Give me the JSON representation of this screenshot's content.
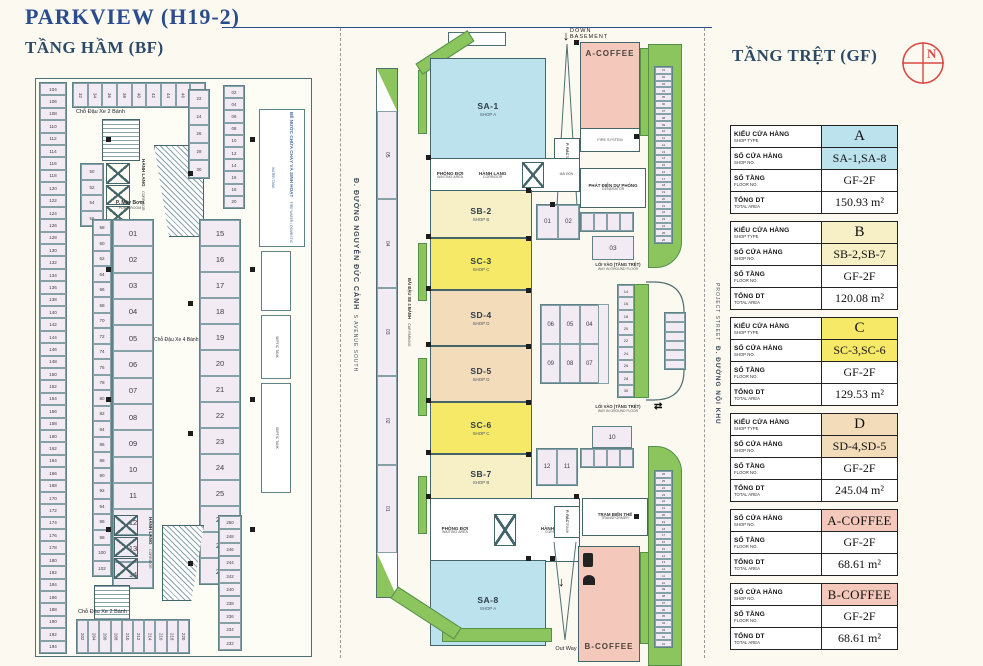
{
  "page": {
    "title": "PARKVIEW (H19-2)",
    "bf_title": "TẦNG HẦM (BF)",
    "gf_title": "TẦNG TRỆT (GF)",
    "compass": "N"
  },
  "colors": {
    "shopA": "#bce2ee",
    "shopB": "#f7f0c6",
    "shopC": "#f6e967",
    "shopD": "#f2dcba",
    "coffee": "#f4c8ba",
    "stall": "#f3ebf3",
    "green": "#8cc45e",
    "accent_red": "#d84a44",
    "title_blue": "#2b4d8e"
  },
  "bf": {
    "bike_top": "Chỗ Đậu Xe 2 Bánh",
    "bike_bottom": "Chỗ Đậu Xe 2 Bánh",
    "car": "Chỗ Đậu Xe 4 Bánh",
    "pump_vn": "P. Máy Bơm",
    "pump_en": "PUMP ROOM",
    "corridor_vn": "HÀNH LANG",
    "corridor_en": "CORRIDOR",
    "tank_vn": "BỂ NƯỚC CHỨA CHÁY VÀ SINH HOẠT",
    "tank_en": "FIRE WATER / DOMESTIC WATER TANK",
    "septic_en": "SEPTIC TANK",
    "left_stalls": [
      "104",
      "106",
      "108",
      "110",
      "112",
      "114",
      "116",
      "118",
      "120",
      "122",
      "124",
      "126",
      "128",
      "130",
      "132",
      "134",
      "136",
      "138",
      "140",
      "142",
      "144",
      "146",
      "148",
      "150",
      "152",
      "154",
      "156",
      "158",
      "160",
      "162",
      "164",
      "166",
      "168",
      "170",
      "172",
      "174",
      "176",
      "178",
      "180",
      "182",
      "184",
      "186",
      "188",
      "190",
      "192",
      "194"
    ],
    "inner_stalls": [
      "58",
      "60",
      "62",
      "64",
      "66",
      "68",
      "70",
      "72",
      "74",
      "76",
      "78",
      "80",
      "82",
      "84",
      "86",
      "88",
      "90",
      "92",
      "94",
      "96",
      "98",
      "100",
      "102"
    ],
    "big_left": [
      "01",
      "02",
      "03",
      "04",
      "05",
      "06",
      "07",
      "08",
      "09",
      "10",
      "11",
      "12",
      "13",
      "14"
    ],
    "big_right": [
      "15",
      "16",
      "17",
      "18",
      "19",
      "20",
      "21",
      "22",
      "23",
      "24",
      "25",
      "26",
      "27",
      "28"
    ],
    "top_stalls": [
      "32",
      "34",
      "36",
      "38",
      "40",
      "42",
      "44",
      "46",
      "48"
    ],
    "cluster_stalls": [
      "50",
      "52",
      "54",
      "56"
    ],
    "mid_top_stalls": [
      "22",
      "24",
      "26",
      "28",
      "30"
    ],
    "right_top_stalls": [
      "02",
      "04",
      "06",
      "08",
      "10",
      "12",
      "14",
      "16",
      "18",
      "20"
    ],
    "bottom_stalls": [
      "202",
      "204",
      "206",
      "208",
      "210",
      "212",
      "214",
      "216",
      "218",
      "220"
    ],
    "bottom_right_stalls": [
      "250",
      "248",
      "246",
      "244",
      "242",
      "240",
      "238",
      "236",
      "234",
      "232"
    ]
  },
  "gf": {
    "down1": "DOWN",
    "down2": "BASEMENT",
    "out_way": "Out Way",
    "way_vn": "LỐI VÀO (TẦNG TRỆT)",
    "way_en": "WAY IN GROUND FLOOR",
    "way_arrow": "⇄",
    "waiting_vn": "PHÒNG ĐỢI",
    "waiting_en": "WAITING AREA",
    "corridor_vn": "HÀNH LANG",
    "corridor_en": "CORRIDOR",
    "canopy": "MÁI ĐÓN",
    "trash_vn": "P. RÁC",
    "trash_en": "TRASH",
    "gen_vn": "PHÁT ĐIỆN DỰ PHÒNG",
    "gen_en": "GENERATOR",
    "fire": "FIRE SYSTEM",
    "trafo_vn": "TRẠM BIẾN THẾ",
    "trafo_en": "TRANSFORMER",
    "road_left_vn": "Đ. ĐƯỜNG NGUYỄN ĐỨC CẢNH",
    "road_left_en": "S AVENUE SOUTH",
    "road_right_vn": "Đ. ĐƯỜNG NỘI KHU",
    "road_right_en": "PROJECT STREET",
    "carpark_vn": "BÃI ĐẬU XE 4 BÁNH",
    "carpark_en": "CAR PARKING",
    "shops": {
      "sa1": {
        "name": "SA-1",
        "sub": "SHOP A"
      },
      "sb2": {
        "name": "SB-2",
        "sub": "SHOP B"
      },
      "sc3": {
        "name": "SC-3",
        "sub": "SHOP C"
      },
      "sd4": {
        "name": "SD-4",
        "sub": "SHOP D"
      },
      "sd5": {
        "name": "SD-5",
        "sub": "SHOP D"
      },
      "sc6": {
        "name": "SC-6",
        "sub": "SHOP C"
      },
      "sb7": {
        "name": "SB-7",
        "sub": "SHOP B"
      },
      "sa8": {
        "name": "SA-8",
        "sub": "SHOP A"
      },
      "acoffee": {
        "name": "A-COFFEE"
      },
      "bcoffee": {
        "name": "B-COFFEE"
      }
    },
    "car_stalls": [
      "05",
      "04",
      "03",
      "02",
      "01"
    ],
    "pair_top": [
      "01",
      "02"
    ],
    "stall03": "03",
    "mid_row1": [
      "06",
      "05",
      "04"
    ],
    "mid_row2": [
      "09",
      "08",
      "07"
    ],
    "stall10": "10",
    "pair_bottom": [
      "12",
      "11"
    ],
    "right_top_stalls": [
      "01",
      "02",
      "03",
      "04",
      "05",
      "06",
      "07",
      "08",
      "09",
      "10",
      "11",
      "12",
      "13",
      "14",
      "15",
      "16",
      "17",
      "18",
      "19",
      "20",
      "21",
      "22",
      "23",
      "24",
      "25",
      "26"
    ],
    "right_mid_stalls": [
      "14",
      "16",
      "18",
      "20",
      "22",
      "24",
      "26",
      "28",
      "30"
    ],
    "right_bottom_stalls": [
      "26",
      "25",
      "24",
      "23",
      "22",
      "21",
      "20",
      "19",
      "18",
      "17",
      "16",
      "15",
      "14",
      "13",
      "12",
      "11",
      "10",
      "09",
      "08",
      "07",
      "06",
      "05",
      "04",
      "03",
      "02",
      "01"
    ]
  },
  "legend": {
    "tableA": [
      {
        "label": "KIỂU CỬA HÀNG",
        "sub": "SHOP TYPE",
        "value": "A",
        "cls": "cA big"
      },
      {
        "label": "SỐ CỬA HÀNG",
        "sub": "SHOP NO.",
        "value": "SA-1,SA-8",
        "cls": "cA"
      },
      {
        "label": "SỐ TẦNG",
        "sub": "FLOOR NO.",
        "value": "GF-2F",
        "cls": ""
      },
      {
        "label": "TỔNG DT",
        "sub": "TOTAL AREA",
        "value": "150.93 m²",
        "cls": ""
      }
    ],
    "tableB": [
      {
        "label": "KIỂU CỬA HÀNG",
        "sub": "SHOP TYPE",
        "value": "B",
        "cls": "cB big"
      },
      {
        "label": "SỐ CỬA HÀNG",
        "sub": "SHOP NO.",
        "value": "SB-2,SB-7",
        "cls": "cB"
      },
      {
        "label": "SỐ TẦNG",
        "sub": "FLOOR NO.",
        "value": "GF-2F",
        "cls": ""
      },
      {
        "label": "TỔNG DT",
        "sub": "TOTAL AREA",
        "value": "120.08 m²",
        "cls": ""
      }
    ],
    "tableC": [
      {
        "label": "KIỂU CỬA HÀNG",
        "sub": "SHOP TYPE",
        "value": "C",
        "cls": "cC big"
      },
      {
        "label": "SỐ CỬA HÀNG",
        "sub": "SHOP NO.",
        "value": "SC-3,SC-6",
        "cls": "cC"
      },
      {
        "label": "SỐ TẦNG",
        "sub": "FLOOR NO.",
        "value": "GF-2F",
        "cls": ""
      },
      {
        "label": "TỔNG DT",
        "sub": "TOTAL AREA",
        "value": "129.53 m²",
        "cls": ""
      }
    ],
    "tableD": [
      {
        "label": "KIỂU CỬA HÀNG",
        "sub": "SHOP TYPE",
        "value": "D",
        "cls": "cD big"
      },
      {
        "label": "SỐ CỬA HÀNG",
        "sub": "SHOP NO.",
        "value": "SD-4,SD-5",
        "cls": "cD"
      },
      {
        "label": "SỐ TẦNG",
        "sub": "FLOOR NO.",
        "value": "GF-2F",
        "cls": ""
      },
      {
        "label": "TỔNG DT",
        "sub": "TOTAL AREA",
        "value": "245.04 m²",
        "cls": ""
      }
    ],
    "tableAC": [
      {
        "label": "SỐ CỬA HÀNG",
        "sub": "SHOP NO.",
        "value": "A-COFFEE",
        "cls": "cCof bigc"
      },
      {
        "label": "SỐ TẦNG",
        "sub": "FLOOR NO.",
        "value": "GF-2F",
        "cls": ""
      },
      {
        "label": "TỔNG DT",
        "sub": "TOTAL AREA",
        "value": "68.61 m²",
        "cls": ""
      }
    ],
    "tableBC": [
      {
        "label": "SỐ CỬA HÀNG",
        "sub": "SHOP NO.",
        "value": "B-COFFEE",
        "cls": "cCof bigc"
      },
      {
        "label": "SỐ TẦNG",
        "sub": "FLOOR NO.",
        "value": "GF-2F",
        "cls": ""
      },
      {
        "label": "TỔNG DT",
        "sub": "TOTAL AREA",
        "value": "68.61 m²",
        "cls": ""
      }
    ]
  }
}
